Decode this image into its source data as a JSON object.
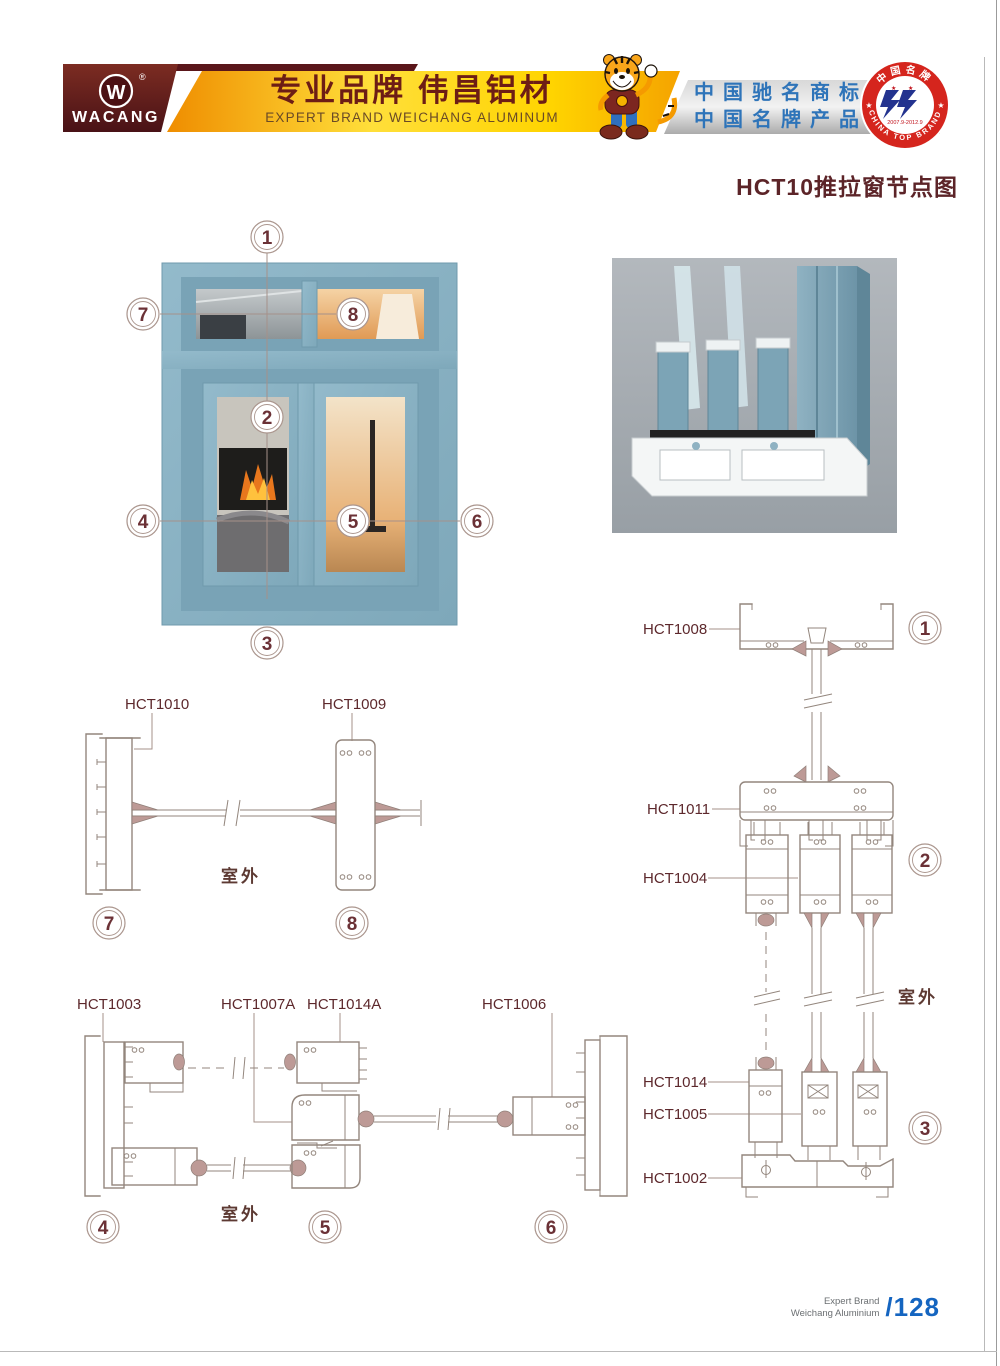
{
  "colors": {
    "maroon_brand": "#5a161a",
    "gold_banner": "#f7b500",
    "honor_blue": "#2e74b9",
    "badge_red": "#d5251d",
    "emblem_blue": "#23338f",
    "frame_blue": "#8ab2c3",
    "line_art": "#93867d",
    "label_maroon": "#5d282c",
    "page_number_blue": "#1565c0"
  },
  "header": {
    "brand": "WACANG",
    "reg_mark": "®",
    "logo_letter": "W",
    "banner_cn": "专业品牌  伟昌铝材",
    "banner_en": "EXPERT BRAND WEICHANG ALUMINUM",
    "honor_line1": "中国驰名商标",
    "honor_line2": "中国名牌产品",
    "badge_top": "中国名牌",
    "badge_bottom": "CHINA TOP BRAND",
    "badge_dates": "2007.9-2012.9",
    "badge_star": "★"
  },
  "title": "HCT10推拉窗节点图",
  "outdoor_label": "室外",
  "callouts": [
    "1",
    "2",
    "3",
    "4",
    "5",
    "6",
    "7",
    "8"
  ],
  "diagrams": {
    "sec78": {
      "label_left": "HCT1010",
      "label_right": "HCT1009"
    },
    "right_col": {
      "l1008": "HCT1008",
      "l1011": "HCT1011",
      "l1004": "HCT1004",
      "l1014": "HCT1014",
      "l1005": "HCT1005",
      "l1002": "HCT1002"
    },
    "sec456": {
      "l1003": "HCT1003",
      "l1007a": "HCT1007A",
      "l1014a": "HCT1014A",
      "l1006": "HCT1006"
    }
  },
  "footer": {
    "line1": "Expert Brand",
    "line2": "Weichang Aluminium",
    "page": "/128"
  }
}
